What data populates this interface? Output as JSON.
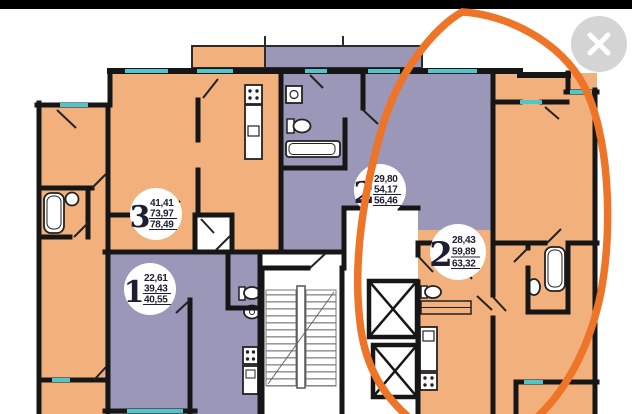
{
  "viewer": {
    "close_button": {
      "label": "close"
    }
  },
  "floor_plan": {
    "type": "residential-floor-plan",
    "apartments": [
      {
        "key": "apt-3",
        "number": "3",
        "areas": [
          "41,41",
          "73,97",
          "78,49"
        ],
        "fill": "#f1b07c"
      },
      {
        "key": "apt-1",
        "number": "1",
        "areas": [
          "22,61",
          "39,43",
          "40,55"
        ],
        "fill": "#9b97b8"
      },
      {
        "key": "apt-2-top",
        "number": "2",
        "areas": [
          "29,80",
          "54,17",
          "56,46"
        ],
        "fill": "#9b97b8"
      },
      {
        "key": "apt-2-right",
        "number": "2",
        "areas": [
          "28,43",
          "59,89",
          "63,32"
        ],
        "fill": "#f1b07c"
      }
    ],
    "colors": {
      "wall": "#161616",
      "window": "#4fc6cb",
      "orange_room": "#f1b07c",
      "purple_room": "#9b97b8",
      "core": "#ffffff",
      "top_bar": "#000000",
      "balcony_border": "#2a2a2a"
    },
    "annotation": {
      "shape": "hand-drawn-ellipse",
      "color": "#ee7428",
      "highlights": "apt-2-right"
    }
  }
}
